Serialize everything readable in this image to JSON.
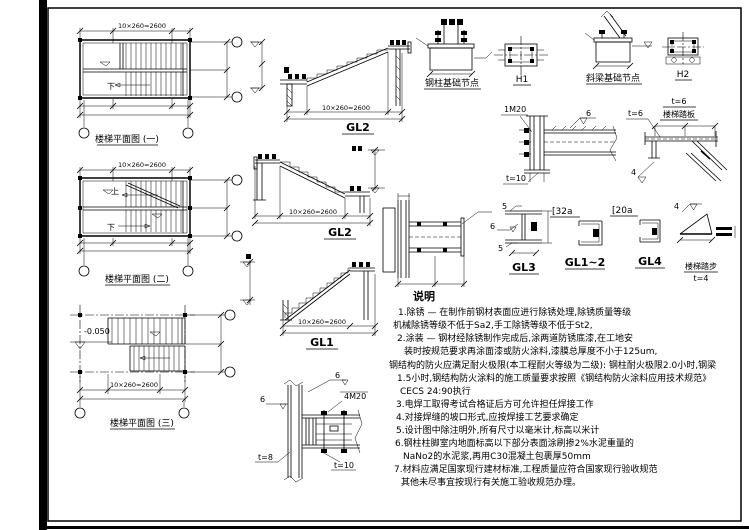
{
  "page": {
    "background": "#ffffff",
    "line_color": "#000000"
  },
  "plans": {
    "plan1": {
      "caption": "楼梯平面图 (一)",
      "down_label": "下",
      "mid_dim": "10×260=2600"
    },
    "plan2": {
      "caption": "楼梯平面图 (二)",
      "up_label": "上",
      "down_label": "下",
      "mid_dim": "10×260=2600"
    },
    "plan3": {
      "caption": "楼梯平面图 (三)",
      "elevation": "-0.050",
      "mid_dim": "10×260=2600"
    }
  },
  "sections": {
    "gl2_top": {
      "label": "GL2",
      "mid_dim": "10×260=2600"
    },
    "gl2_mid": {
      "label": "GL2",
      "mid_dim": "10×260=2600"
    },
    "gl1": {
      "label": "GL1",
      "mid_dim": "10×260=2600"
    }
  },
  "base_details": {
    "col_base_caption": "钢柱基础节点",
    "h1_caption": "H1",
    "beam_base_caption": "斜梁基础节点",
    "h2_caption": "H2"
  },
  "conn_details": {
    "beam_col": {
      "bolt_label": "1M20",
      "weld_label": "6",
      "plate_label": "t=10"
    },
    "tread_plate": {
      "title_top": "t=6",
      "title_sub": "楼梯踏板",
      "leader_label": "t=6",
      "weld_label": "4"
    },
    "col_splice": {
      "weld_top": "6",
      "weld_left": "6",
      "bolt_label": "4M20",
      "plate_left": "t=8",
      "plate_bottom": "t=10"
    }
  },
  "member_sections": {
    "gl3": {
      "caption": "GL3",
      "weld_top": "5",
      "weld_mid": "6",
      "weld_bot": "5"
    },
    "gl12": {
      "caption": "GL1~2",
      "size": "[32a"
    },
    "gl4": {
      "caption": "GL4",
      "size": "[20a"
    },
    "tread": {
      "caption": "楼梯踏步",
      "thickness": "t=4",
      "weld": "4"
    }
  },
  "notes": {
    "title": "说明",
    "lines": [
      "1.除锈 — 在制作前钢材表面应进行除锈处理,除锈质量等级",
      "机械除锈等级不低于Sa2,手工除锈等级不低于St2,",
      "2.涂装 — 钢材经除锈制作完成后,涂两道防锈底漆,在工地安",
      "装时按规范要求再涂面漆或防火涂料,漆膜总厚度不小于125um,",
      "钢结构的防火应满足耐火极限(本工程耐火等级为二级):  钢柱耐火极限2.0小时,钢梁",
      "1.5小时,钢结构防火涂料的施工质量要求按照《钢结构防火涂料应用技术规范》",
      "CECS 24:90执行",
      "3.电焊工取得考试合格证后方可允许担任焊接工作",
      "4.对接焊缝的坡口形式,应按焊接工艺要求确定",
      "5.设计图中除注明外,所有尺寸以毫米计,标高以米计",
      "6.钢柱柱脚室内地面标高以下部分表面涂刷掺2%水泥重量的",
      "NaNo2的水泥浆,再用C30混凝土包裹厚50mm",
      "7.材料应满足国家现行建材标准,工程质量应符合国家现行验收规范",
      "其他未尽事宜按现行有关施工验收规范办理。"
    ]
  }
}
